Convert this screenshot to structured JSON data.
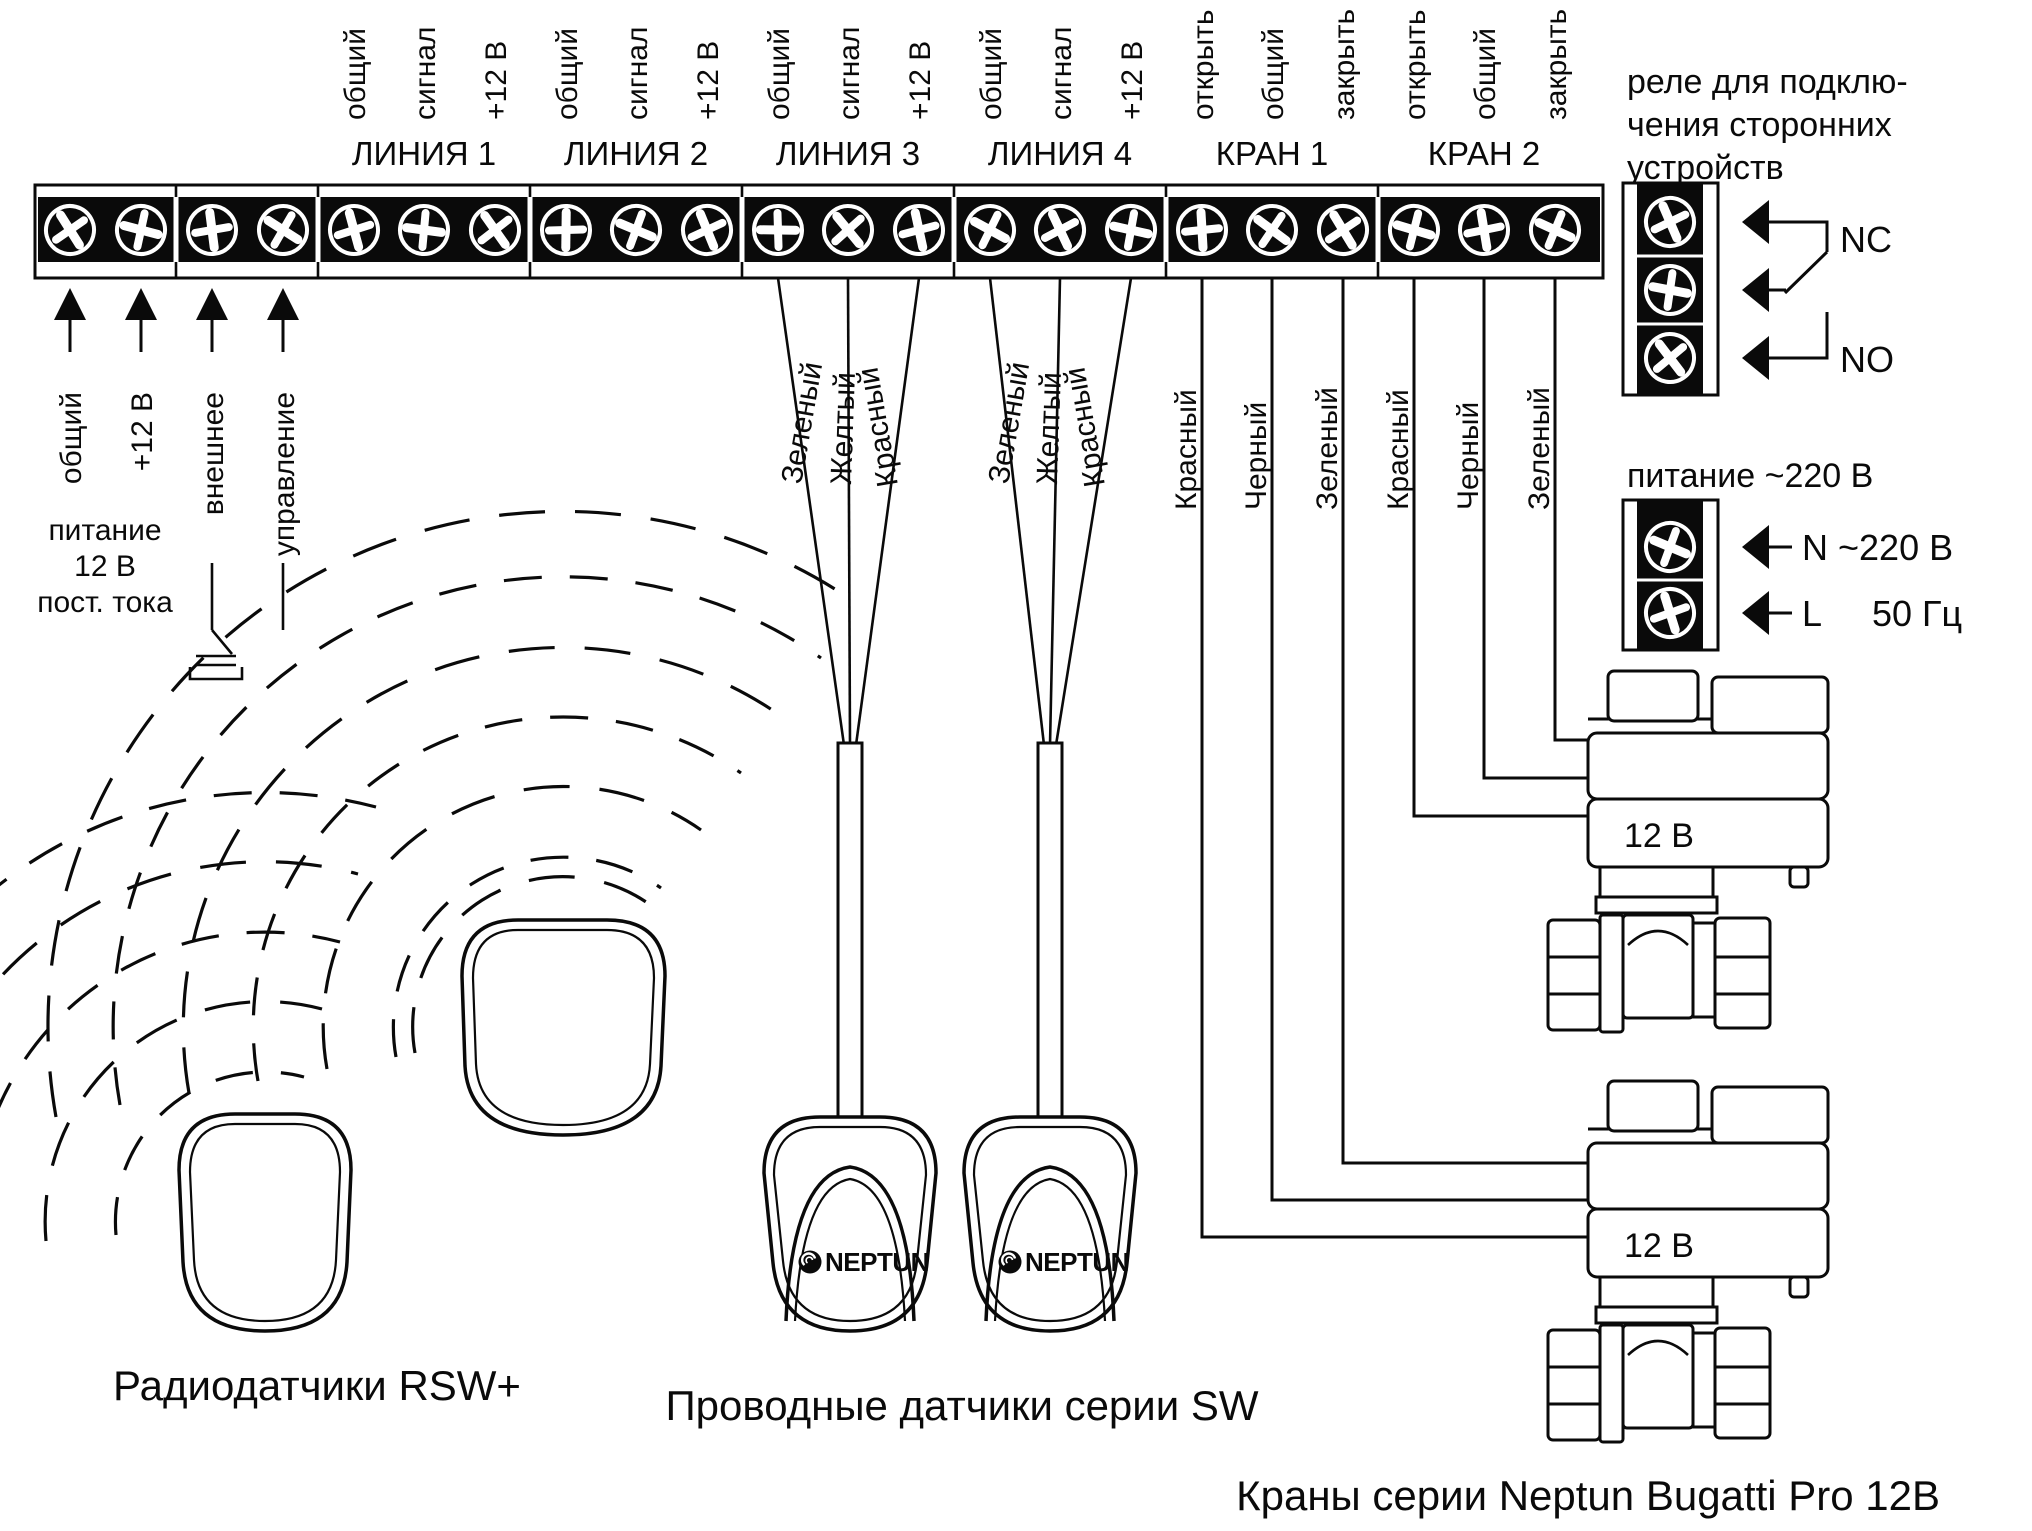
{
  "strip": {
    "power_pins": [
      "общий",
      "+12 В"
    ],
    "power_caption": [
      "питание",
      "12 В",
      "пост. тока"
    ],
    "ext_pins": [
      "внешнее",
      "управление"
    ],
    "groups": [
      {
        "name": "ЛИНИЯ 1",
        "pins": [
          "общий",
          "сигнал",
          "+12 В"
        ]
      },
      {
        "name": "ЛИНИЯ 2",
        "pins": [
          "общий",
          "сигнал",
          "+12 В"
        ]
      },
      {
        "name": "ЛИНИЯ 3",
        "pins": [
          "общий",
          "сигнал",
          "+12 В"
        ]
      },
      {
        "name": "ЛИНИЯ 4",
        "pins": [
          "общий",
          "сигнал",
          "+12 В"
        ]
      },
      {
        "name": "КРАН 1",
        "pins": [
          "открыть",
          "общий",
          "закрыть"
        ]
      },
      {
        "name": "КРАН 2",
        "pins": [
          "открыть",
          "общий",
          "закрыть"
        ]
      }
    ]
  },
  "wires": {
    "sensor3": [
      "Зеленый",
      "Желтый",
      "Красный"
    ],
    "sensor4": [
      "Зеленый",
      "Желтый",
      "Красный"
    ],
    "valve1": [
      "Красный",
      "Черный",
      "Зеленый"
    ],
    "valve2": [
      "Красный",
      "Черный",
      "Зеленый"
    ]
  },
  "relay": {
    "caption": [
      "реле для подклю-",
      "чения сторонних",
      "устройств"
    ],
    "nc": "NC",
    "no": "NO"
  },
  "power220": {
    "title": "питание ~220 В",
    "n": "N ~220 В",
    "l": "L",
    "hz": "50 Гц"
  },
  "valves": {
    "label": "12 В",
    "caption": "Краны серии Neptun Bugatti Pro 12В"
  },
  "sensors": {
    "brand": "NEPTUN",
    "wired_caption": "Проводные датчики серии SW",
    "radio_caption": "Радиодатчики RSW+"
  }
}
